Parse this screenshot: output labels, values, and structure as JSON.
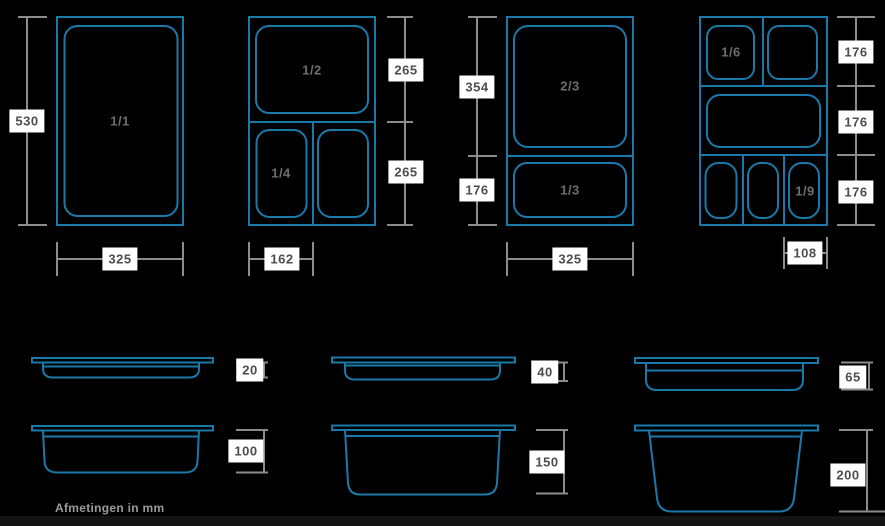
{
  "note": "Afmetingen in mm",
  "colors": {
    "background": "#000000",
    "pan_outline_blue": "#1b79a9",
    "dimension_gray": "#8c8c8c",
    "label_bg": "#ffffff",
    "label_text": "#4d4d4d",
    "pan_label_text": "#6e6e6e",
    "note_text": "#9b9b9b"
  },
  "top_views": [
    {
      "id": "gn-1-1",
      "pan_labels": [
        "1/1"
      ],
      "height_dims": [
        "530"
      ],
      "width_dim": "325"
    },
    {
      "id": "gn-1-2-1-4",
      "pan_labels": [
        "1/2",
        "1/4"
      ],
      "height_dims": [
        "265",
        "265"
      ],
      "width_dim": "162"
    },
    {
      "id": "gn-2-3-1-3",
      "pan_labels": [
        "2/3",
        "1/3"
      ],
      "height_dims": [
        "354",
        "176"
      ],
      "width_dim": "325"
    },
    {
      "id": "gn-1-6-1-9",
      "pan_labels": [
        "1/6",
        "1/9"
      ],
      "height_dims": [
        "176",
        "176",
        "176"
      ],
      "width_dim": "108"
    }
  ],
  "side_views": [
    {
      "id": "depth-20",
      "depth": "20"
    },
    {
      "id": "depth-40",
      "depth": "40"
    },
    {
      "id": "depth-65",
      "depth": "65"
    },
    {
      "id": "depth-100",
      "depth": "100"
    },
    {
      "id": "depth-150",
      "depth": "150"
    },
    {
      "id": "depth-200",
      "depth": "200"
    }
  ]
}
